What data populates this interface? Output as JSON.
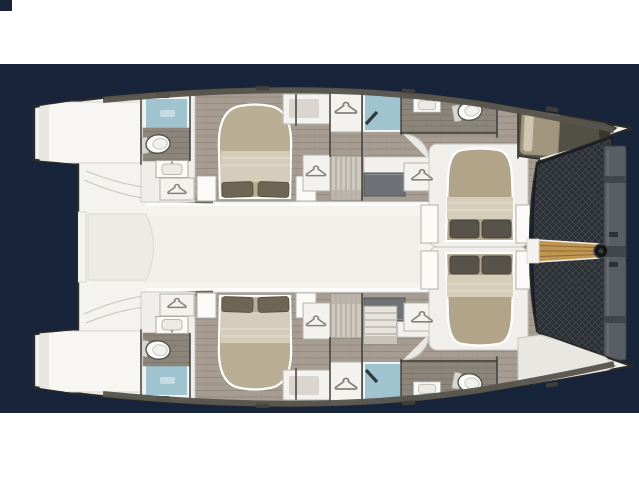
{
  "scene": {
    "title": "Catamaran interior layout floor plan",
    "view": "top-down floorplan, bow pointing right, hull sterns at left",
    "text_content": "none"
  },
  "colors": {
    "background_navy": "#18243a",
    "band_white": "#ffffff",
    "hull_fill": "#f4f3f0",
    "hull_outline": "#2b2b28",
    "roof_band": "#57554d",
    "wood_floor": "#a69c92",
    "wood_plank_line": "#948a80",
    "bath_floor": "#8b857c",
    "bath_floor_line": "#79746b",
    "shower_blue": "#9fc3cf",
    "bed_khaki": "#b9ad93",
    "bed_blanket": "#d5cdba",
    "pillow_brown": "#6e6554",
    "center_bed_khaki": "#b1a489",
    "center_pillow": "#57524a",
    "furniture_white": "#f4f2ee",
    "furniture_outline": "#b5b2ab",
    "counter_gray": "#6e7276",
    "trampoline_dark": "#2c3034",
    "trampoline_mesh": "#4e5458",
    "crossbeam_gray": "#595e63",
    "bowsprit_wood": "#c0954f",
    "forepeak_dark": "#524f44",
    "forepeak_berth": "#a1967d",
    "wall_line": "#3f3e3a",
    "saloon_tint": "#f1efe9",
    "handrail_gray": "#6b6861"
  },
  "inventory": {
    "hulls": [
      "top-hull",
      "bottom-hull"
    ],
    "double_cabins": 4,
    "bow_berth": 1,
    "bathrooms": 4,
    "shower_stalls": 4,
    "toilets": 4,
    "sinks": 4,
    "wardrobe_hanger_icons": 8,
    "stairways": 2,
    "deck_features": [
      "saloon",
      "stern-platforms",
      "trampoline-net",
      "bowsprit",
      "forward-crossbeam"
    ]
  }
}
